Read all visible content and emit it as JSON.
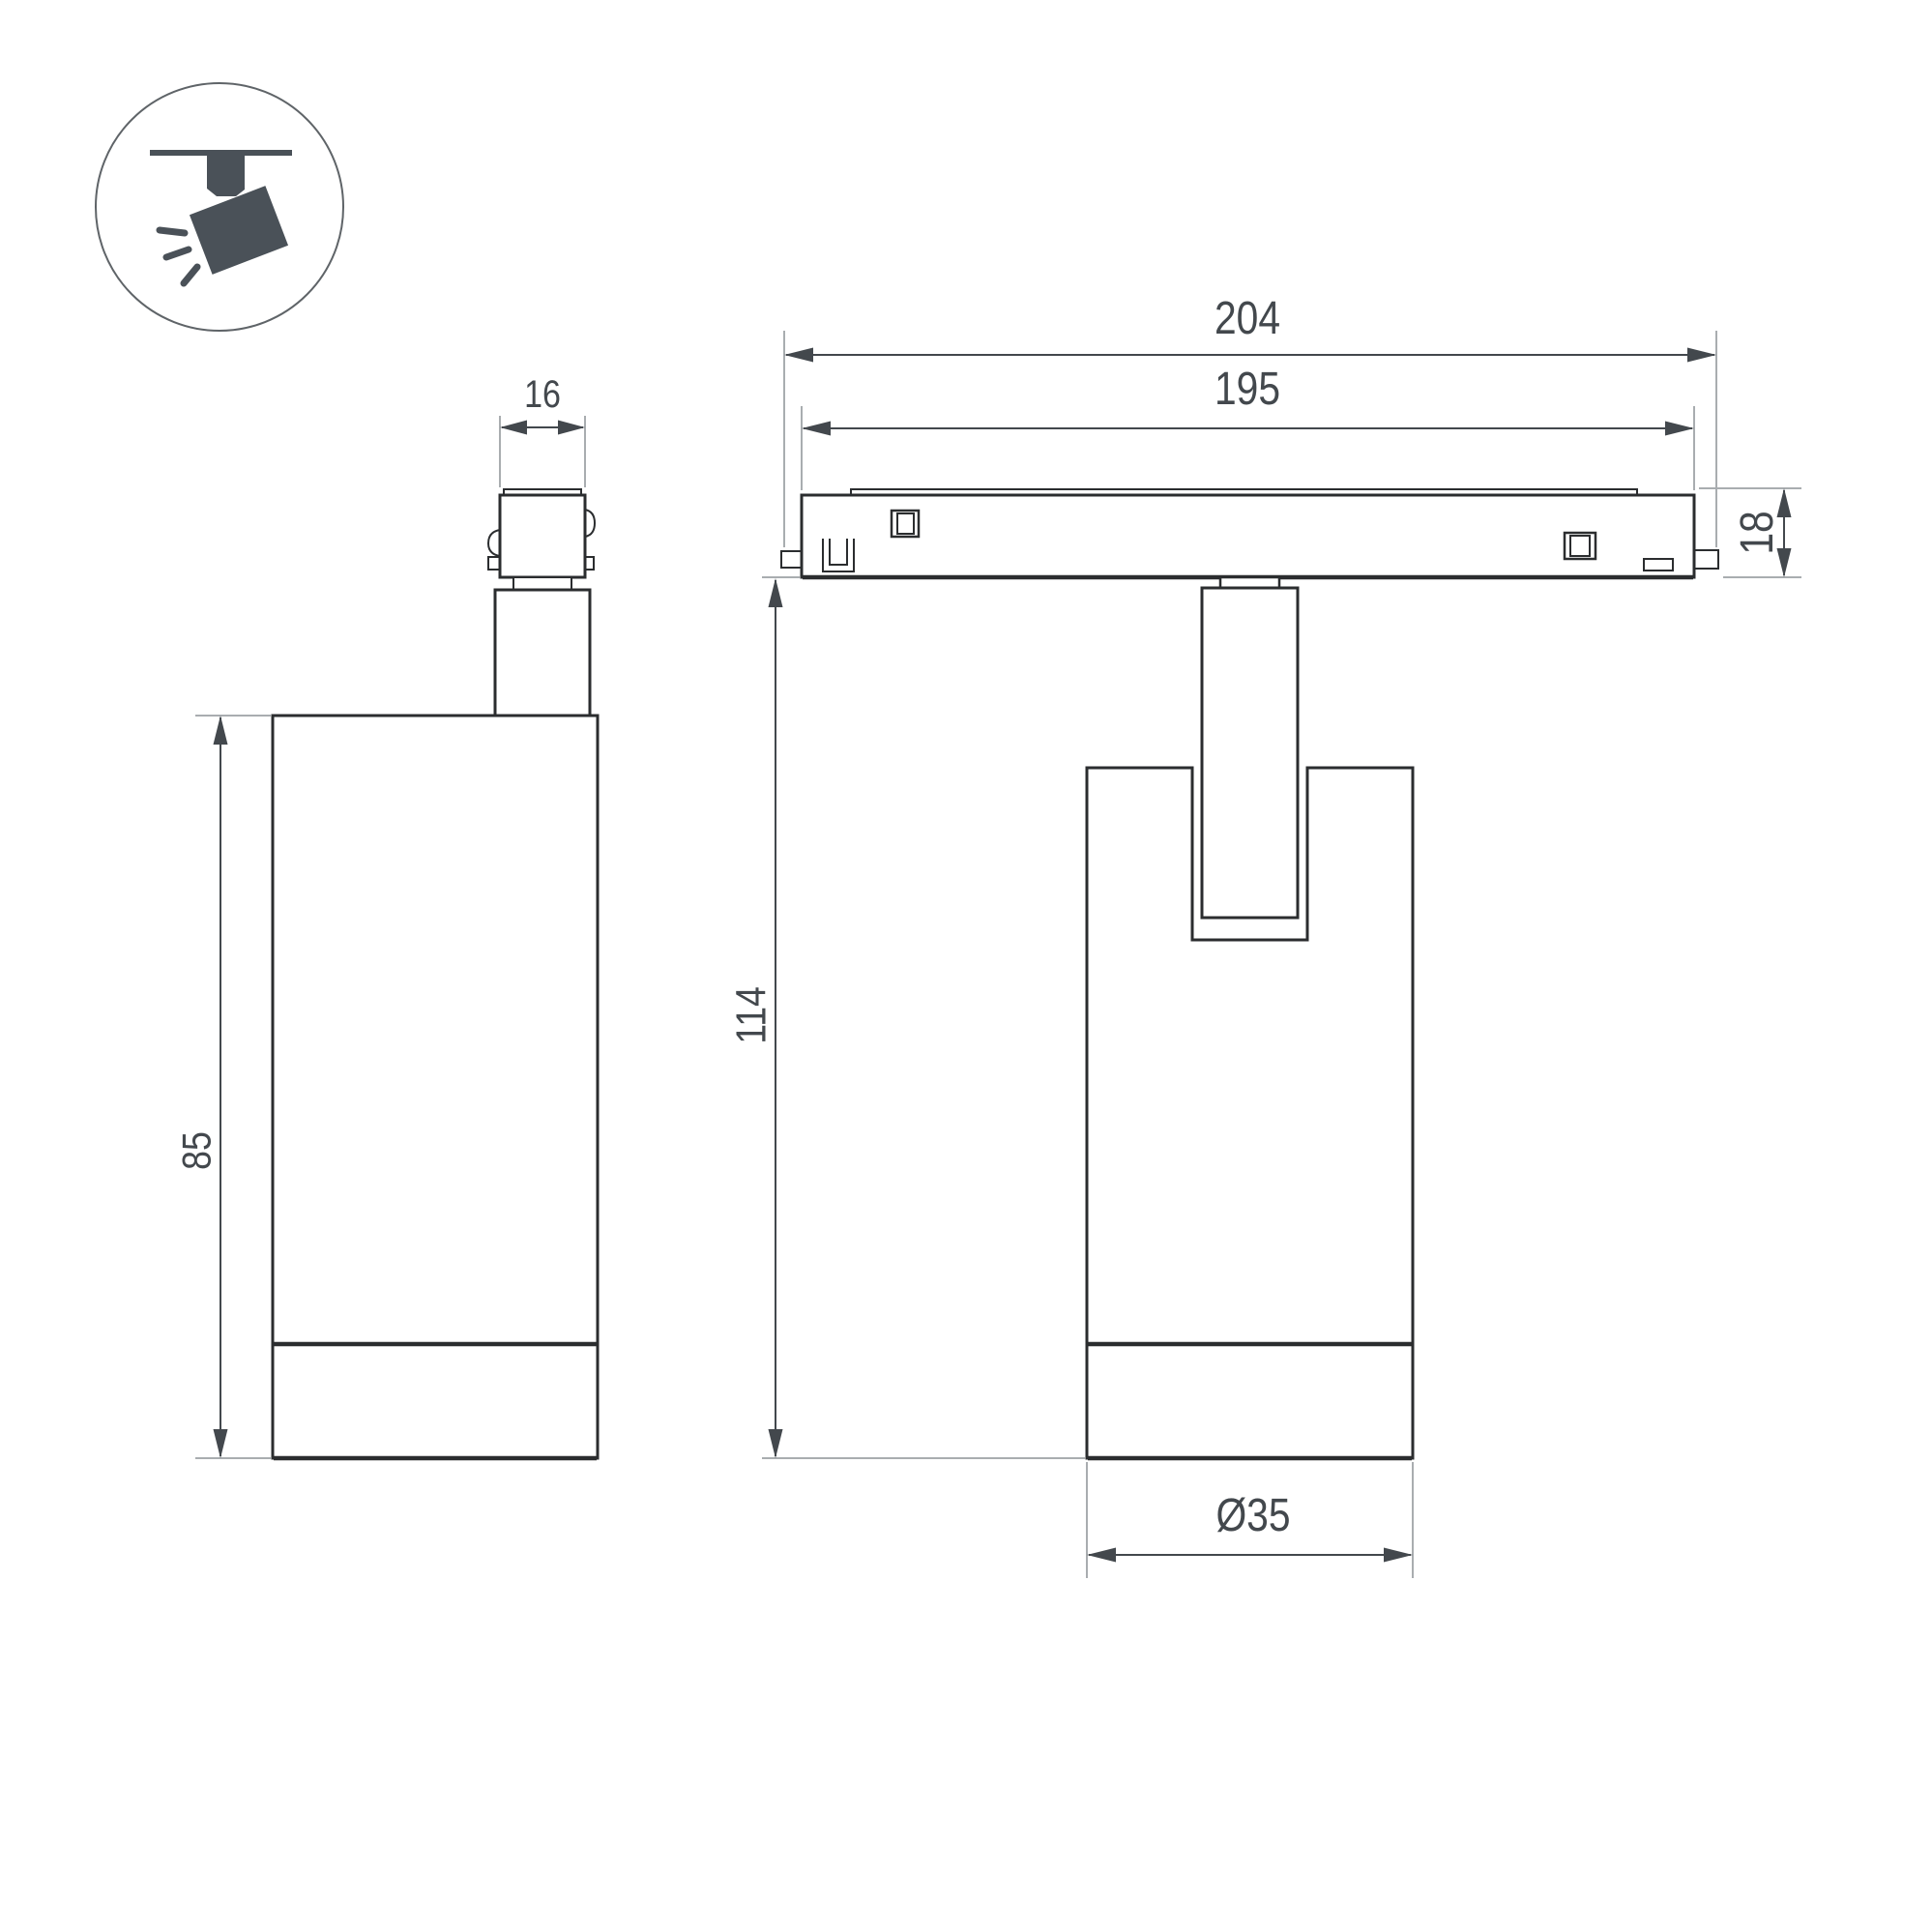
{
  "icons": {
    "badge": "track-spotlight-icon"
  },
  "dimensions": {
    "adapter_width": "16",
    "body_height": "85",
    "track_outer_length": "204",
    "track_inner_length": "195",
    "track_height": "18",
    "fixture_height": "114",
    "body_diameter": "Ø35"
  },
  "colors": {
    "background": "#ffffff",
    "outline": "#2b2d2f",
    "dimension": "#43484d",
    "extension": "#a9adb0",
    "icon_fill": "#4a5158",
    "circle_stroke": "#5f6468"
  }
}
